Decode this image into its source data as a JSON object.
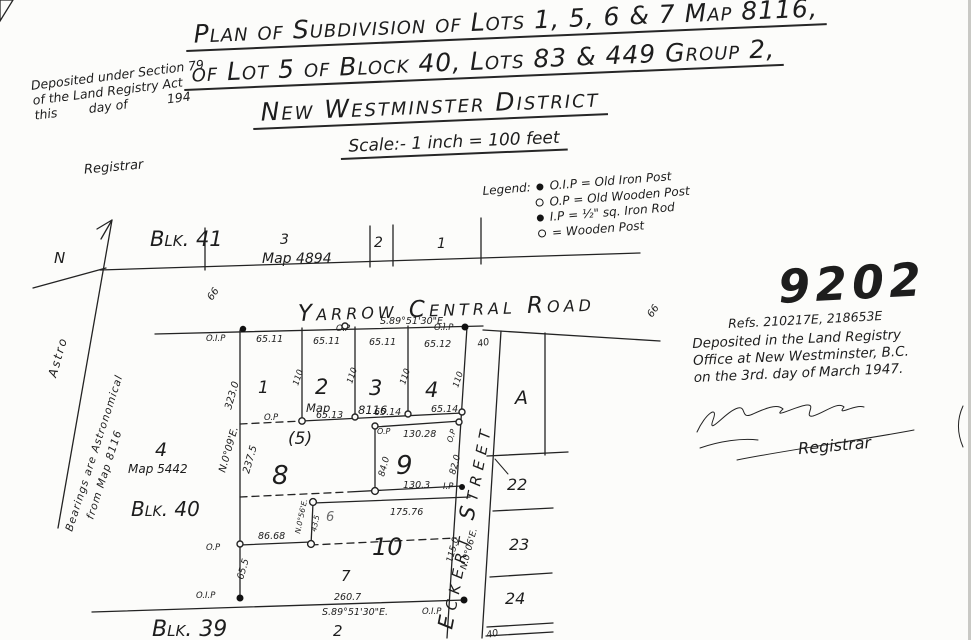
{
  "colors": {
    "ink": "#1d1d1d",
    "paper": "#fcfcfa"
  },
  "title": {
    "line1": "Plan of Subdivision of Lots 1, 5, 6 & 7 Map 8116,",
    "line2": "of Lot 5 of Block 40, Lots 83 & 449 Group 2,",
    "line3": "New Westminster District",
    "scale": "Scale:- 1 inch = 100 feet"
  },
  "deposit_note": {
    "line1": "Deposited under Section 79",
    "line2": "of the Land Registry Act",
    "line3": "this        day of          194",
    "registrar": "Registrar"
  },
  "plan_number": "9202",
  "refs": "Refs. 210217E, 218653E",
  "registry_stamp": {
    "line1": "Deposited in the Land Registry",
    "line2": "Office at New Westminster, B.C.",
    "line3": "on the 3rd. day of March 1947.",
    "registrar": "Registrar"
  },
  "legend": {
    "title": "Legend:",
    "items": [
      {
        "symbol": "filled-dot",
        "label": "O.I.P = Old Iron Post"
      },
      {
        "symbol": "open-dot",
        "label": "O.P = Old Wooden Post"
      },
      {
        "symbol": "filled-dot",
        "label": "I.P = ½\" sq. Iron Rod"
      },
      {
        "symbol": "open-dot",
        "label": "=  Wooden Post"
      }
    ]
  },
  "north_note": {
    "n": "N",
    "astro": "Astro",
    "line1": "Bearings are Astronomical",
    "line2": "from Map 8116"
  },
  "map_labels": {
    "blk41": "Blk. 41",
    "lot3_top": "3",
    "map4894": "Map 4894",
    "lot2_top": "2",
    "lot1_top": "1",
    "yarrow": "Yarrow Central Road",
    "road_width_left": "66",
    "road_width_right": "66",
    "oip_a": "O.I.P",
    "m6511a": "65.11",
    "op_a": "O.P",
    "brg_top": "S.89°51'30\"E.",
    "oip_b": "O.I.P",
    "m6511b": "65.11",
    "m6511c": "65.11",
    "m6512": "65.12",
    "w40_top": "40",
    "lot1": "1",
    "lot2": "2",
    "map_word": "Map",
    "lot3": "3",
    "map8116": "8116",
    "lot4": "4",
    "d110a": "110",
    "d110b": "110",
    "d110c": "110",
    "d110d": "110",
    "op_b": "O.P",
    "m6513": "65.13",
    "m6514a": "65.14",
    "m6514b": "65.14",
    "lot5": "(5)",
    "lot8": "8",
    "op_c": "O.P",
    "m13028": "130.28",
    "op_d": "O.P",
    "lot9": "9",
    "v84": "84.0",
    "v82": "82.0",
    "brg_west": "N.0°09'E.",
    "v3230": "323.0",
    "v2375": "237.5",
    "lot4_map": "4",
    "map5442": "Map 5442",
    "blk40": "Blk. 40",
    "m1303": "130.3",
    "ip_a": "I.P",
    "lot22": "22",
    "brg_jog": "N.0°56'E.",
    "v435": "43.5",
    "lot6": "6",
    "m17576": "175.76",
    "op_e": "O.P",
    "m8668": "86.68",
    "lot10": "10",
    "lot23": "23",
    "v655": "65.5",
    "lot7": "7",
    "v1150": "115.0",
    "brg_eck": "N.0°06'E.",
    "oip_c": "O.I.P",
    "m2607": "260.7",
    "brg_bot": "S.89°51'30\"E.",
    "oip_d": "O.I.P",
    "lot24": "24",
    "blk39": "Blk. 39",
    "lot2_bot": "2",
    "w40_bot": "40",
    "eckert": "Eckert Street",
    "lotA": "A"
  }
}
